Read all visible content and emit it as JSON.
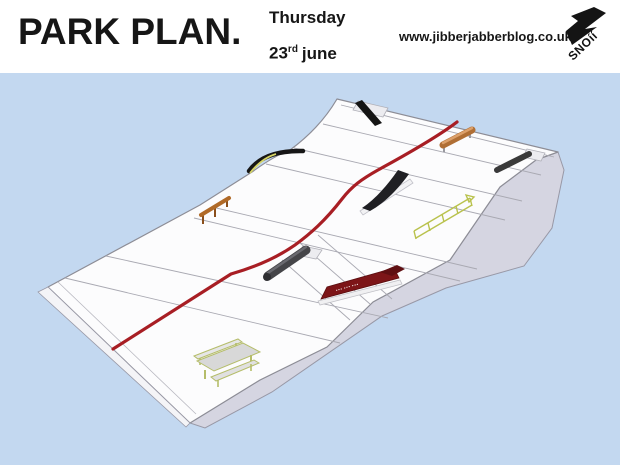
{
  "header": {
    "title": "PARK PLAN.",
    "date": {
      "weekday": "Thursday",
      "day": "23",
      "ordinal": "rd",
      "month": "june"
    },
    "website": "www.jibberjabberblog.co.uk",
    "logo_text": "SNOíí"
  },
  "park": {
    "background_color": "#c3d8f0",
    "snow_color": "#fcfcfd",
    "side_face_color": "#d5d5e1",
    "edge_band_color": "#f4f4f7",
    "grid_line_color": "#a9a9b2",
    "run_line_color": "#a81e24",
    "wallride_marks": "••• ••• •••",
    "features": [
      {
        "id": "flat-rail-top",
        "color": "#141414"
      },
      {
        "id": "orange-tube-rail",
        "color": "#b06f35"
      },
      {
        "id": "grey-tube-rail",
        "color": "#3a3a3a"
      },
      {
        "id": "curved-rail",
        "color": "#161616"
      },
      {
        "id": "a-frame-rail",
        "color": "#b06a28"
      },
      {
        "id": "kicker-wedge",
        "color": "#202024"
      },
      {
        "id": "ladder-rail",
        "color": "#b9c24d"
      },
      {
        "id": "barrel-tube",
        "color": "#454549"
      },
      {
        "id": "wallride",
        "color": "#7d1518"
      },
      {
        "id": "picnic-table",
        "color": "#d8d8d8"
      }
    ]
  }
}
